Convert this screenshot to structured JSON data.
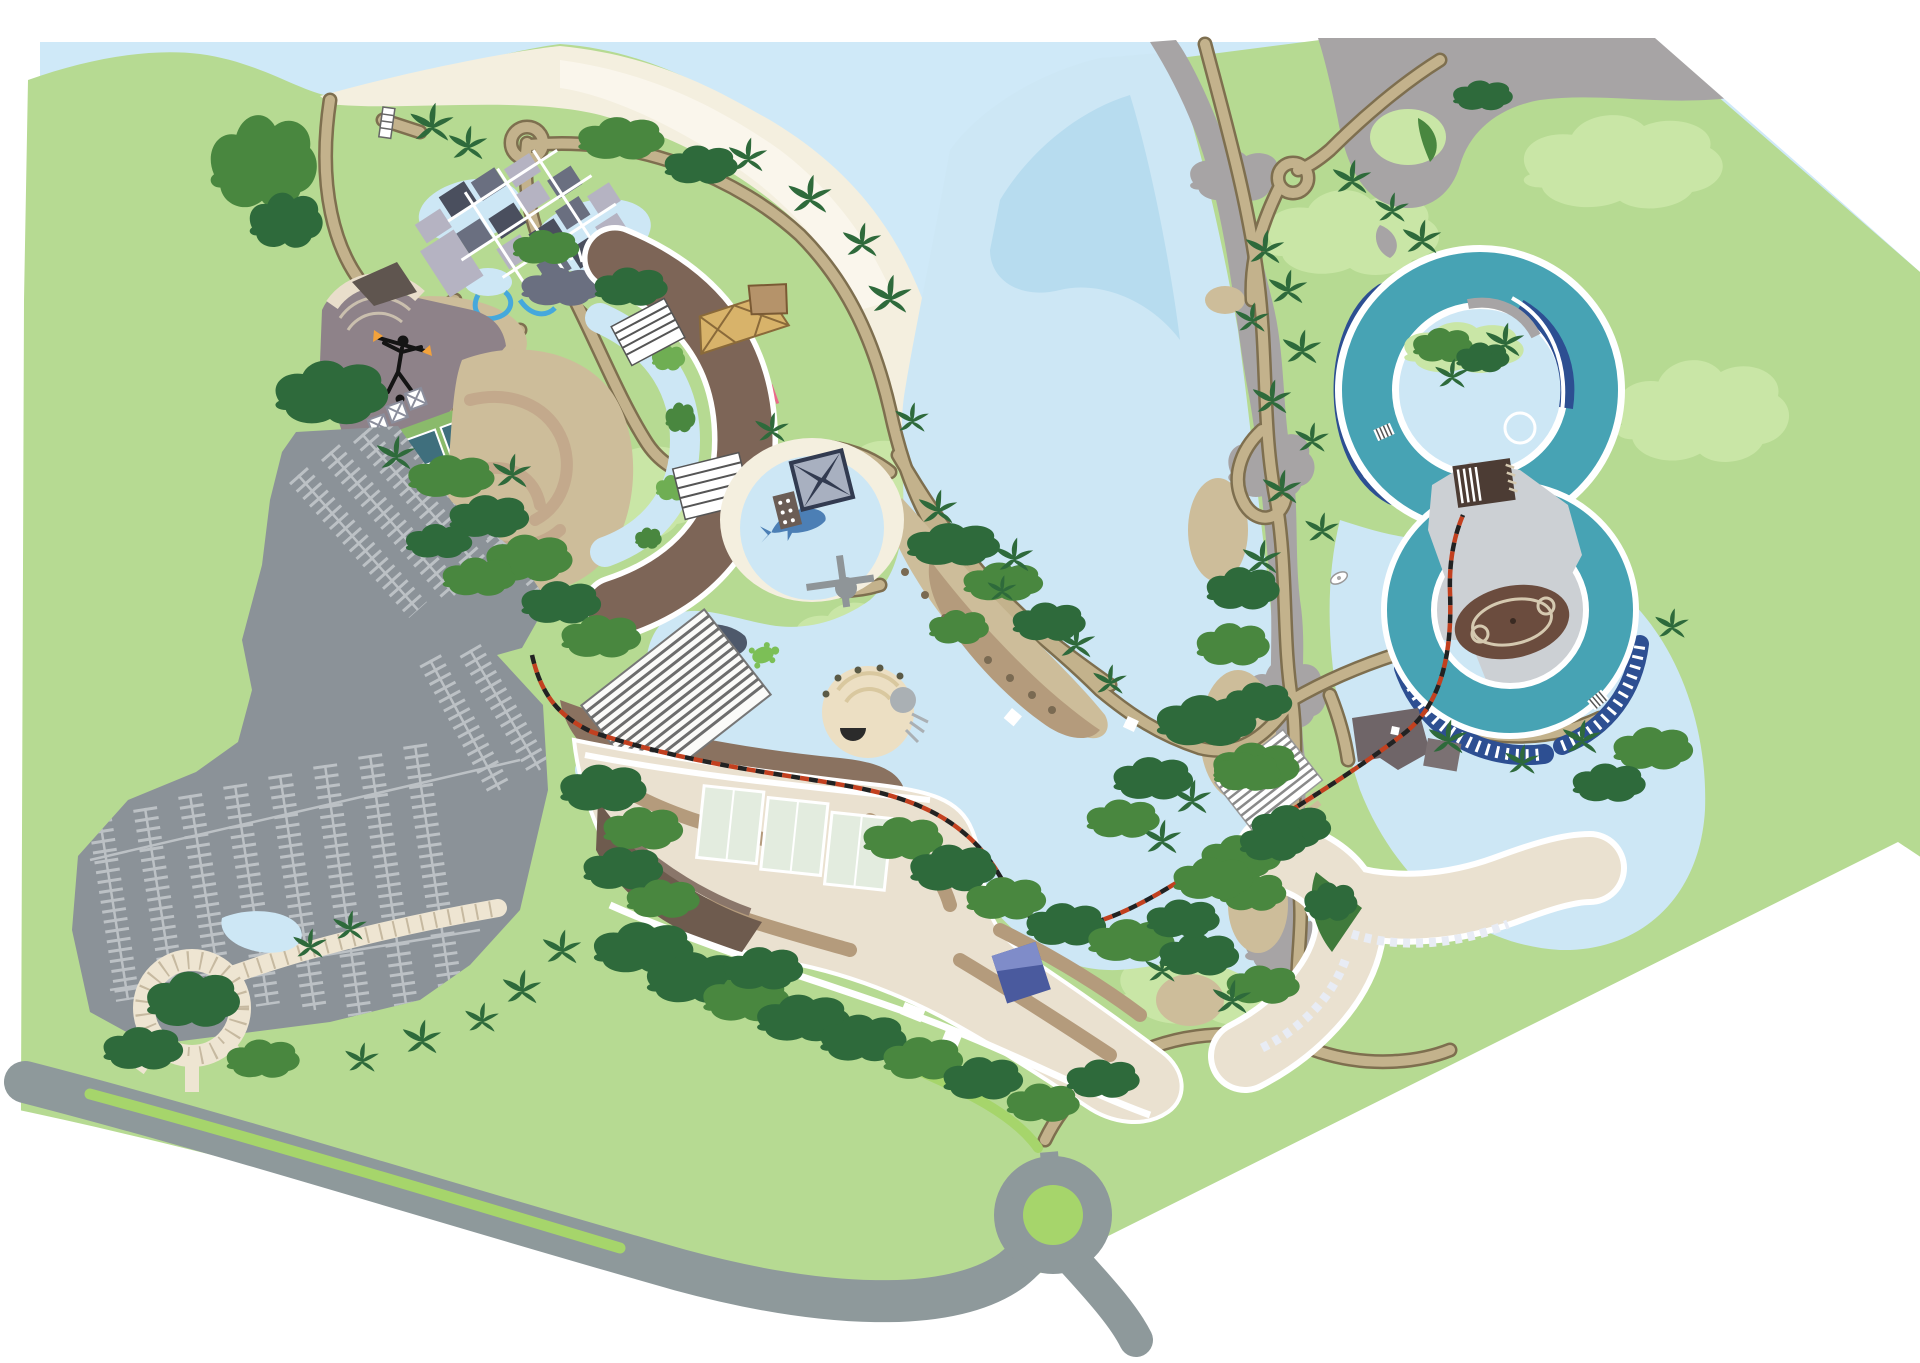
{
  "map": {
    "kind": "illustrated-resort-map",
    "visible_text": "none",
    "features": [
      {
        "id": "ocean",
        "name": "ocean"
      },
      {
        "id": "beach",
        "name": "beach-shoreline"
      },
      {
        "id": "lagoon",
        "name": "central-lagoon"
      },
      {
        "id": "winding-river",
        "name": "winding-river"
      },
      {
        "id": "rocky-coastline",
        "name": "rocky-coastline"
      },
      {
        "id": "bungalow-village",
        "name": "bungalow-village"
      },
      {
        "id": "village-ponds",
        "name": "village-ponds"
      },
      {
        "id": "boat-pier",
        "name": "boat-pier"
      },
      {
        "id": "trail-roundabout",
        "name": "trail-roundabout"
      },
      {
        "id": "fire-dancer-plaza",
        "name": "fire-dancer-amphitheater"
      },
      {
        "id": "fire-dancer-icon",
        "name": "fire-dancer-icon"
      },
      {
        "id": "tennis-courts",
        "name": "tennis-courts"
      },
      {
        "id": "crescent-hotel",
        "name": "crescent-hotel-towers"
      },
      {
        "id": "hotel-pool-river",
        "name": "hotel-pool-river"
      },
      {
        "id": "pool-deck",
        "name": "terraced-pool-deck"
      },
      {
        "id": "beach-lodge",
        "name": "beach-lodge"
      },
      {
        "id": "dolphin-lagoon",
        "name": "dolphin-lagoon"
      },
      {
        "id": "dolphin-icon",
        "name": "dolphin-icon"
      },
      {
        "id": "observation-pier",
        "name": "observation-pier"
      },
      {
        "id": "four-roof-pavilion",
        "name": "four-roof-pavilion"
      },
      {
        "id": "beach-spit",
        "name": "beach-spit-with-umbrellas"
      },
      {
        "id": "kayaks",
        "name": "kayak-racks"
      },
      {
        "id": "sea-turtle-icon",
        "name": "sea-turtle-icon"
      },
      {
        "id": "waterfall-rocks",
        "name": "waterfall-rocks"
      },
      {
        "id": "conference-roof",
        "name": "striped-conference-roof"
      },
      {
        "id": "grotto-pool",
        "name": "grotto-splash-pool"
      },
      {
        "id": "main-resort-building",
        "name": "main-resort-complex"
      },
      {
        "id": "blue-annex",
        "name": "blue-annex-building"
      },
      {
        "id": "lazy-river-upper-loop",
        "name": "lazy-river-upper-loop"
      },
      {
        "id": "lazy-river-lower-loop",
        "name": "lazy-river-lower-loop"
      },
      {
        "id": "river-island",
        "name": "river-loop-island"
      },
      {
        "id": "stadium-oval",
        "name": "stadium-field"
      },
      {
        "id": "stadium-bleachers",
        "name": "stadium-bleachers"
      },
      {
        "id": "stadium-plaza",
        "name": "stadium-plaza"
      },
      {
        "id": "raft-steps",
        "name": "river-raft-steps"
      },
      {
        "id": "tour-boat",
        "name": "tour-boat"
      },
      {
        "id": "y-hotel",
        "name": "y-shaped-hotel"
      },
      {
        "id": "y-hotel-atrium",
        "name": "striped-atrium-roof"
      },
      {
        "id": "courtyard-garden",
        "name": "courtyard-garden"
      },
      {
        "id": "service-building",
        "name": "service-building"
      },
      {
        "id": "parking-lot",
        "name": "parking-lot"
      },
      {
        "id": "entrance-road",
        "name": "entrance-road"
      },
      {
        "id": "roundabout",
        "name": "road-roundabout"
      },
      {
        "id": "road-median",
        "name": "road-median-strip"
      },
      {
        "id": "paver-promenade",
        "name": "paver-promenade"
      },
      {
        "id": "promenade-circle",
        "name": "promenade-circle"
      },
      {
        "id": "garden-pond",
        "name": "garden-pond"
      },
      {
        "id": "tram-line",
        "name": "tram-line"
      },
      {
        "id": "trails",
        "name": "walking-trails"
      },
      {
        "id": "palm-tree",
        "name": "palm-tree"
      },
      {
        "id": "tree-cluster",
        "name": "tree-cluster"
      }
    ]
  },
  "palette": {
    "white": "#ffffff",
    "ocean": "#cfe9f8",
    "land": "#b6da92",
    "landLight": "#c9e6a6",
    "landBright": "#a6d56b",
    "beach": "#f4efdf",
    "beachLight": "#faf6ec",
    "sand": "#cdbd9a",
    "sandShadow": "#b49b7c",
    "sandDark": "#8a7260",
    "path": "#c3b28c",
    "pathEdge": "#7e6f4f",
    "paver": "#eee5d2",
    "paverLine": "#c6b9a0",
    "road": "#8e999b",
    "parking": "#8b9298",
    "parkLine": "#bcc1c5",
    "rock": "#a7a4a5",
    "water": "#cde7f5",
    "waterDeep": "#b7dcef",
    "stream": "#45a8dc",
    "teal": "#47a3b4",
    "navy": "#2d4f92",
    "hotel": "#7d6557",
    "hotelDark": "#5e4a40",
    "cream": "#eae1d0",
    "creamEdge": "#c9b9a4",
    "glass": "#e3ecdf",
    "slate": "#6a6f80",
    "slateLight": "#b5b3c2",
    "slateDark": "#4a4f5e",
    "pavNavy": "#323b50",
    "pavLight": "#a8b0c0",
    "stadium": "#6b4c3e",
    "stadiumLine": "#d5c9b0",
    "plaza": "#ccd0d4",
    "mauve": "#8e8289",
    "mauveDark": "#6f6568",
    "treeDark": "#2e6a3b",
    "treeMid": "#49873f",
    "treeLight": "#6fae53",
    "tramRed": "#c2401f",
    "tramDark": "#222222",
    "flame": "#f2a23c",
    "dolphin": "#4c7fb5",
    "turtle": "#7cbf56",
    "tennisPad": "#8aba6b",
    "court": "#3f6f7d",
    "blueBldg": "#4a5a9e",
    "blueBldgRoof": "#7f8cc9"
  }
}
